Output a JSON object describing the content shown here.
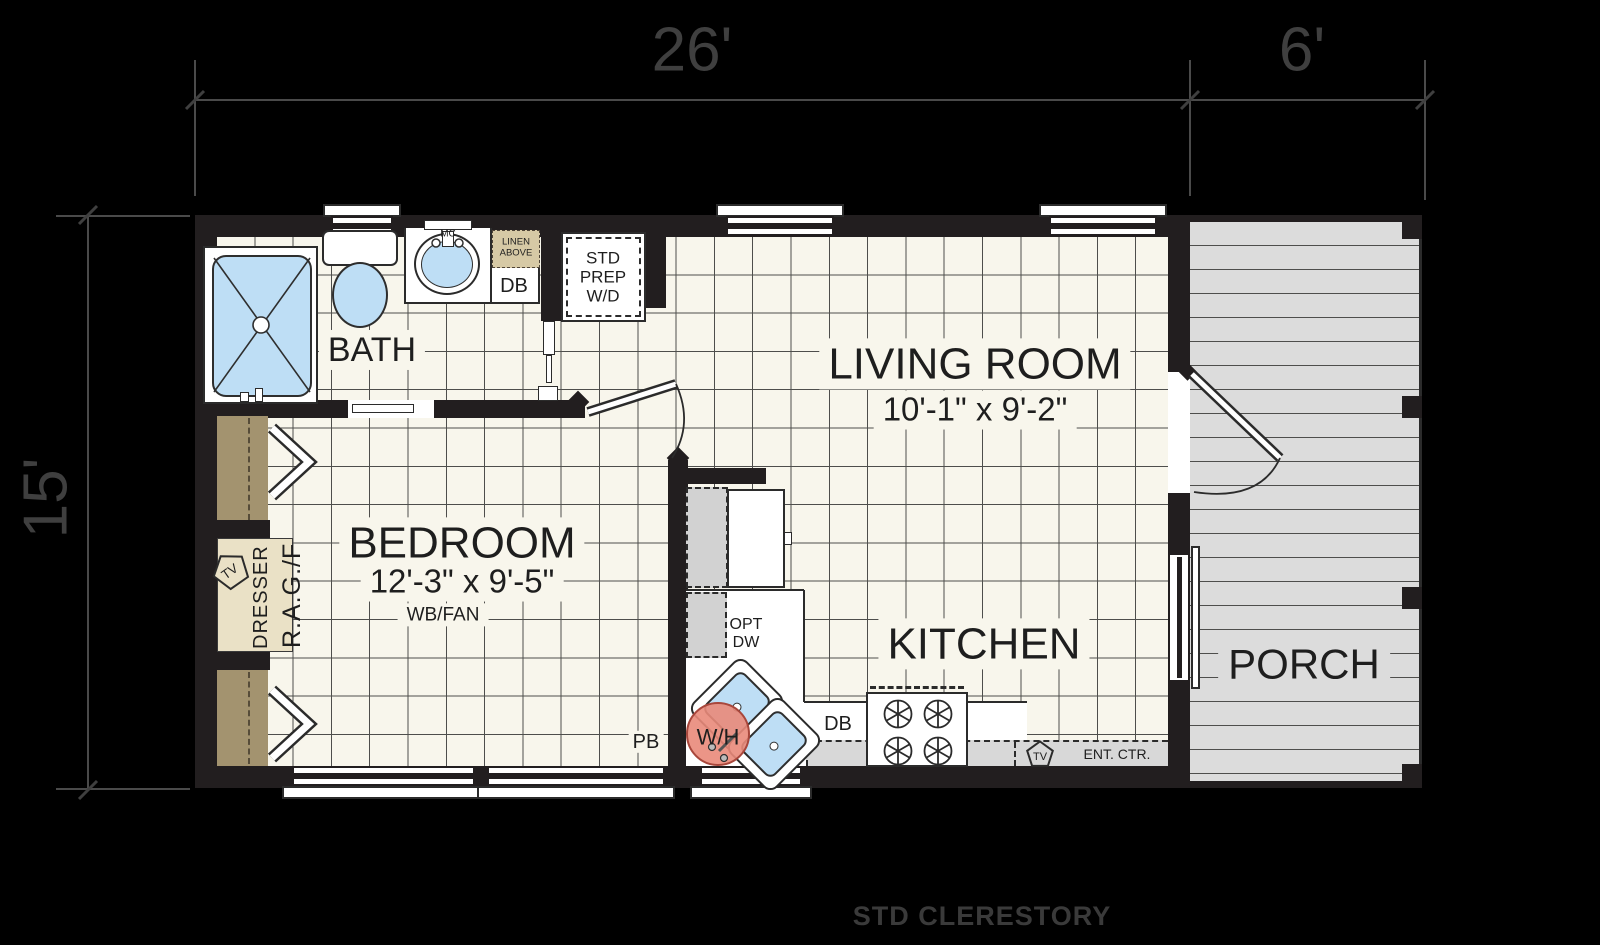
{
  "dimensions": {
    "overall_width": "26'",
    "porch_width": "6'",
    "overall_depth": "15'"
  },
  "footer": {
    "label": "STD CLERESTORY"
  },
  "rooms": {
    "bath": {
      "label": "BATH"
    },
    "bedroom": {
      "label": "BEDROOM",
      "size": "12'-3\" x 9'-5\"",
      "note": "WB/FAN"
    },
    "living_room": {
      "label": "LIVING ROOM",
      "size": "10'-1\" x 9'-2\""
    },
    "kitchen": {
      "label": "KITCHEN"
    },
    "porch": {
      "label": "PORCH"
    }
  },
  "labels": {
    "medicine_cabinet": "MC",
    "linen": "LINEN ABOVE",
    "bath_drawer_base": "DB",
    "washer_dryer": "STD PREP W/D",
    "closet_tv": "TV",
    "dresser": "DRESSER",
    "range_hookup": "R.A.G./F",
    "plumbing_box": "PB",
    "opt_dishwasher": "OPT DW",
    "water_heater": "W/H",
    "kitchen_drawer_base": "DB",
    "entertainment_center": "ENT. CTR.",
    "ent_center_tv": "TV"
  },
  "colors": {
    "background": "#000000",
    "walls": "#221e1f",
    "floor": "#f8f6ec",
    "grid_line": "#4e4e4c",
    "fixture_blue": "#bedef5",
    "water_heater_fill": "#e8897a",
    "deck": "#dcdcdc",
    "closet_tan": "#a3936f",
    "dresser_tan": "#eae1c6",
    "linen_tan": "#d6c9a5",
    "dimension_text": "#3f3f3f"
  }
}
